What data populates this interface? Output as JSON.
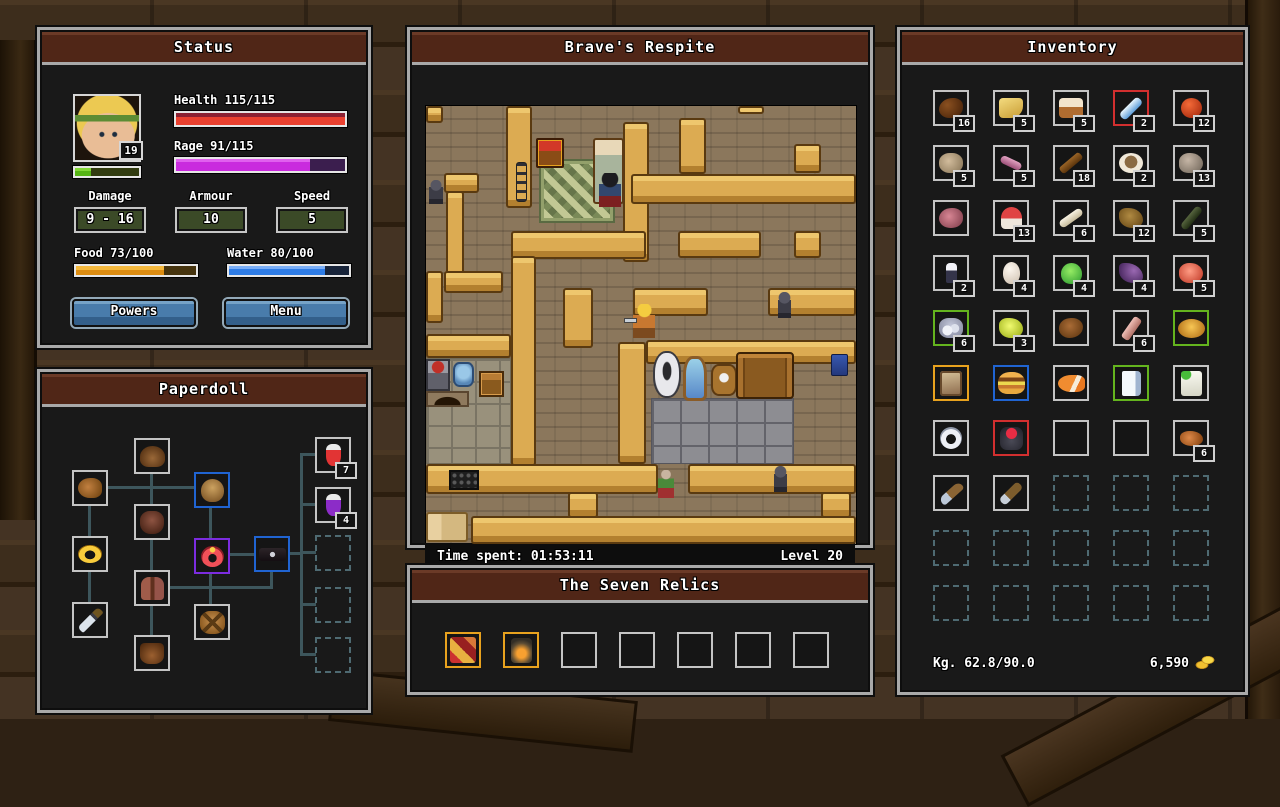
{
  "colors": {
    "title_bar": "#502617",
    "accent_gold": "#e8a21e",
    "border_red": "#d22f2f",
    "border_green": "#64b41e",
    "border_blue": "#2064d2",
    "border_purple": "#7c2ce0",
    "button_blue": "#497cab"
  },
  "status": {
    "title": "Status",
    "level": "19",
    "health_label": "Health 115/115",
    "health_pct": 100,
    "rage_label": "Rage 91/115",
    "rage_pct": 79,
    "xp_pct": 25,
    "stats": [
      {
        "label": "Damage",
        "value": "9 - 16"
      },
      {
        "label": "Armour",
        "value": "10"
      },
      {
        "label": "Speed",
        "value": "5"
      }
    ],
    "food_label": "Food 73/100",
    "food_pct": 73,
    "water_label": "Water 80/100",
    "water_pct": 80,
    "powers_label": "Powers",
    "menu_label": "Menu"
  },
  "paperdoll": {
    "title": "Paperdoll",
    "slots": [
      {
        "name": "helmet",
        "glyph": "furhat",
        "x": 92,
        "y": 31
      },
      {
        "name": "hands",
        "glyph": "glove",
        "x": 30,
        "y": 63
      },
      {
        "name": "head",
        "glyph": "headslot",
        "x": 152,
        "y": 65,
        "border": "blue"
      },
      {
        "name": "chest",
        "glyph": "chestarmor",
        "x": 92,
        "y": 97
      },
      {
        "name": "ring",
        "glyph": "goldring",
        "x": 30,
        "y": 129
      },
      {
        "name": "amulet",
        "glyph": "redamulet",
        "x": 152,
        "y": 131,
        "border": "purple"
      },
      {
        "name": "belt",
        "glyph": "beltitem",
        "x": 212,
        "y": 129,
        "border": "blue"
      },
      {
        "name": "legs",
        "glyph": "pants",
        "x": 92,
        "y": 163
      },
      {
        "name": "weapon",
        "glyph": "sword",
        "x": 30,
        "y": 195
      },
      {
        "name": "back",
        "glyph": "backpack",
        "x": 152,
        "y": 197
      },
      {
        "name": "feet",
        "glyph": "boots",
        "x": 92,
        "y": 228
      },
      {
        "name": "quick-slot-1",
        "glyph": "redpotion",
        "x": 273,
        "y": 30,
        "count": "7"
      },
      {
        "name": "quick-slot-2",
        "glyph": "purplepotion",
        "x": 273,
        "y": 80,
        "count": "4"
      },
      {
        "name": "quick-slot-3",
        "x": 273,
        "y": 128,
        "locked": true
      },
      {
        "name": "quick-slot-4",
        "x": 273,
        "y": 180,
        "locked": true
      },
      {
        "name": "quick-slot-5",
        "x": 273,
        "y": 230,
        "locked": true
      }
    ],
    "lines": [
      [
        108,
        65,
        3,
        165
      ],
      [
        46,
        97,
        3,
        100
      ],
      [
        63,
        79,
        90,
        3
      ],
      [
        167,
        99,
        3,
        100
      ],
      [
        186,
        146,
        28,
        3
      ],
      [
        228,
        162,
        3,
        20
      ],
      [
        126,
        179,
        105,
        3
      ],
      [
        246,
        145,
        14,
        3
      ],
      [
        258,
        46,
        3,
        202
      ],
      [
        258,
        46,
        16,
        3
      ],
      [
        258,
        96,
        16,
        3
      ],
      [
        258,
        144,
        16,
        3
      ],
      [
        258,
        196,
        16,
        3
      ],
      [
        258,
        246,
        16,
        3
      ]
    ]
  },
  "map": {
    "title": "Brave's Respite",
    "time": "Time spent: 01:53:11",
    "level": "Level 20",
    "beams": [
      [
        0,
        0,
        17,
        17
      ],
      [
        80,
        0,
        26,
        102
      ],
      [
        197,
        16,
        26,
        140
      ],
      [
        253,
        12,
        27,
        56
      ],
      [
        312,
        0,
        26,
        8
      ],
      [
        368,
        38,
        27,
        29
      ],
      [
        205,
        68,
        225,
        30
      ],
      [
        18,
        67,
        35,
        20
      ],
      [
        20,
        85,
        18,
        100
      ],
      [
        85,
        125,
        135,
        28
      ],
      [
        85,
        150,
        25,
        210
      ],
      [
        252,
        125,
        83,
        27
      ],
      [
        368,
        125,
        27,
        27
      ],
      [
        0,
        165,
        17,
        52
      ],
      [
        18,
        165,
        59,
        22
      ],
      [
        137,
        182,
        30,
        60
      ],
      [
        207,
        182,
        75,
        28
      ],
      [
        342,
        182,
        88,
        28
      ],
      [
        0,
        228,
        85,
        24
      ],
      [
        192,
        236,
        28,
        122
      ],
      [
        220,
        234,
        210,
        24
      ],
      [
        0,
        358,
        232,
        30
      ],
      [
        262,
        358,
        168,
        30
      ],
      [
        142,
        386,
        30,
        26
      ],
      [
        395,
        386,
        30,
        26
      ],
      [
        45,
        410,
        385,
        28
      ]
    ],
    "objects": [
      [
        "rug",
        115,
        55,
        72,
        60
      ],
      [
        "chest",
        110,
        32,
        28,
        30
      ],
      [
        "bed",
        167,
        32,
        31,
        66
      ],
      [
        "pole",
        90,
        56,
        11,
        40
      ],
      [
        "kstone",
        0,
        252,
        85,
        106
      ],
      [
        "bstone",
        225,
        292,
        143,
        66
      ],
      [
        "stove",
        0,
        253,
        24,
        32
      ],
      [
        "kettle",
        27,
        256,
        21,
        25
      ],
      [
        "furnace",
        0,
        285,
        43,
        16
      ],
      [
        "kchest",
        53,
        265,
        25,
        26
      ],
      [
        "toilet",
        227,
        245,
        28,
        47
      ],
      [
        "mirror",
        257,
        250,
        24,
        45
      ],
      [
        "basin",
        285,
        258,
        26,
        32
      ],
      [
        "dresser",
        310,
        246,
        58,
        47
      ],
      [
        "towel",
        405,
        248,
        17,
        22
      ],
      [
        "grate",
        23,
        364,
        30,
        20
      ],
      [
        "bed2",
        0,
        406,
        42,
        30
      ],
      [
        "statue",
        3,
        74,
        14,
        24
      ],
      [
        "statue",
        352,
        186,
        13,
        26
      ],
      [
        "statue",
        348,
        360,
        13,
        26
      ],
      [
        "npc1",
        173,
        67,
        22,
        34
      ],
      [
        "npc2",
        232,
        364,
        16,
        28
      ],
      [
        "player",
        207,
        198,
        22,
        34
      ]
    ]
  },
  "relics": {
    "title": "The Seven Relics",
    "slots": [
      {
        "item": "patchwork-relic",
        "glyph": "relic1",
        "border": "gold"
      },
      {
        "item": "lantern-relic",
        "glyph": "relic2",
        "border": "gold"
      },
      {},
      {},
      {},
      {},
      {}
    ]
  },
  "inventory": {
    "title": "Inventory",
    "weight": "Kg. 62.8/90.0",
    "gold": "6,590",
    "slots": [
      {
        "item": "dried-meat",
        "glyph": "jerky",
        "count": "16"
      },
      {
        "item": "cheese",
        "glyph": "cheese",
        "count": "5"
      },
      {
        "item": "bread",
        "glyph": "bread",
        "count": "5"
      },
      {
        "item": "feathers",
        "glyph": "feathers",
        "count": "2",
        "border": "red"
      },
      {
        "item": "apple",
        "glyph": "apple",
        "count": "12"
      },
      {
        "item": "hide",
        "glyph": "hide",
        "count": "5"
      },
      {
        "item": "worm",
        "glyph": "worm",
        "count": "5"
      },
      {
        "item": "branch",
        "glyph": "stick",
        "count": "18"
      },
      {
        "item": "stew-bowl",
        "glyph": "bowl",
        "count": "2"
      },
      {
        "item": "stone",
        "glyph": "rock",
        "count": "13"
      },
      {
        "item": "raw-steak",
        "glyph": "steak"
      },
      {
        "item": "red-mushroom",
        "glyph": "mushroom",
        "count": "13"
      },
      {
        "item": "bone",
        "glyph": "bone",
        "count": "6"
      },
      {
        "item": "leather-scrap",
        "glyph": "leather",
        "count": "12"
      },
      {
        "item": "hunting-bow",
        "glyph": "bow",
        "count": "5"
      },
      {
        "item": "figurine",
        "glyph": "figurine",
        "count": "2"
      },
      {
        "item": "egg",
        "glyph": "egg",
        "count": "4"
      },
      {
        "item": "green-slime",
        "glyph": "slime",
        "count": "4"
      },
      {
        "item": "bat-wing",
        "glyph": "wing",
        "count": "4"
      },
      {
        "item": "marbled-meat",
        "glyph": "meat",
        "count": "5"
      },
      {
        "item": "silver-ore",
        "glyph": "ore",
        "count": "6",
        "border": "green"
      },
      {
        "item": "yellow-crystal",
        "glyph": "crystal",
        "count": "3"
      },
      {
        "item": "roast",
        "glyph": "roast"
      },
      {
        "item": "pink-plank",
        "glyph": "plank",
        "count": "6"
      },
      {
        "item": "golden-pie",
        "glyph": "pie",
        "border": "green"
      },
      {
        "item": "brown-tome",
        "glyph": "tome",
        "border": "orange"
      },
      {
        "item": "burger",
        "glyph": "burger",
        "border": "blue"
      },
      {
        "item": "clownfish",
        "glyph": "fish"
      },
      {
        "item": "white-book",
        "glyph": "book",
        "border": "green"
      },
      {
        "item": "signed-scroll",
        "glyph": "scroll"
      },
      {
        "item": "silver-ring",
        "glyph": "ringitem"
      },
      {
        "item": "red-gem-armor",
        "glyph": "armor",
        "border": "red"
      },
      {
        "empty": true
      },
      {
        "empty": true
      },
      {
        "item": "copper-chunks",
        "glyph": "bits",
        "count": "6"
      },
      {
        "item": "pickaxe",
        "glyph": "pickaxe"
      },
      {
        "item": "hatchet",
        "glyph": "axe"
      },
      {
        "locked": true
      },
      {
        "locked": true
      },
      {
        "locked": true
      },
      {
        "locked": true
      },
      {
        "locked": true
      },
      {
        "locked": true
      },
      {
        "locked": true
      },
      {
        "locked": true
      },
      {
        "locked": true
      },
      {
        "locked": true
      },
      {
        "locked": true
      },
      {
        "locked": true
      },
      {
        "locked": true
      }
    ]
  }
}
